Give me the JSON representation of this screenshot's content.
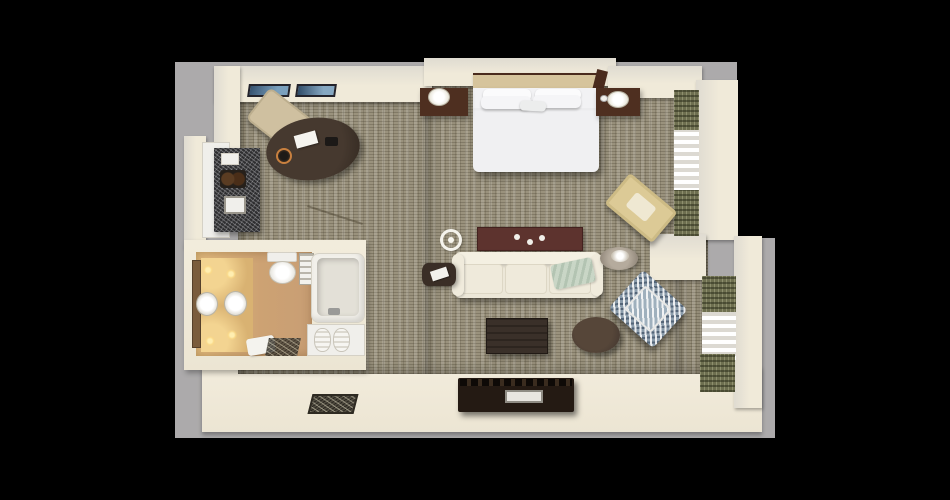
{
  "scene": {
    "type": "3d-top-down-floor-plan",
    "subject": "hotel-studio-suite",
    "rooms": [
      "bedroom-living-area",
      "bathroom",
      "entry",
      "closet-wet-bar",
      "window-bays"
    ],
    "objects": [
      "king-bed",
      "headboard",
      "nightstand-left",
      "nightstand-right",
      "table-lamp-left",
      "table-lamp-right",
      "wall-art-left",
      "wall-art-right",
      "oval-work-desk",
      "desk-chair",
      "desk-notepad",
      "desk-ice-bucket",
      "desk-phone",
      "wet-bar-counter",
      "ceiling-ring-light",
      "maroon-console-table",
      "sofa",
      "throw-blanket",
      "side-table-left",
      "magazine",
      "side-table-right",
      "bed-bench",
      "accent-armchair",
      "round-ottoman",
      "coffee-table",
      "tv-console",
      "tv-console-drawer",
      "doormat",
      "vanity-with-double-sinks",
      "vanity-lights",
      "mirror",
      "toilet",
      "towel-ladder",
      "bathtub",
      "tub-faucet",
      "towel-shelf",
      "rolled-towels",
      "bath-mat",
      "entry-tile",
      "upper-window-curtains",
      "lower-window-curtains"
    ]
  },
  "palette": {
    "bg_black": "#000000",
    "backdrop_gray": "#acaaab",
    "wall_cream": "#efe9dc",
    "carpet_base": "#9a927d",
    "bath_floor_tan": "#cfa878",
    "vanity_wood": "#d9b272",
    "wood_dark": "#3b2f27",
    "wood_brown": "#4e2f20",
    "maroon": "#5d332e",
    "bed_white": "#efeff1",
    "headboard_tan": "#d6c49c",
    "sofa_cream": "#ece7d8",
    "throw_sage": "#c9d6c6",
    "chair_blue": "#8b9cab",
    "olive_drape": "#6e6f50",
    "tv_dark": "#241a13",
    "ottoman_brown": "#463931"
  }
}
